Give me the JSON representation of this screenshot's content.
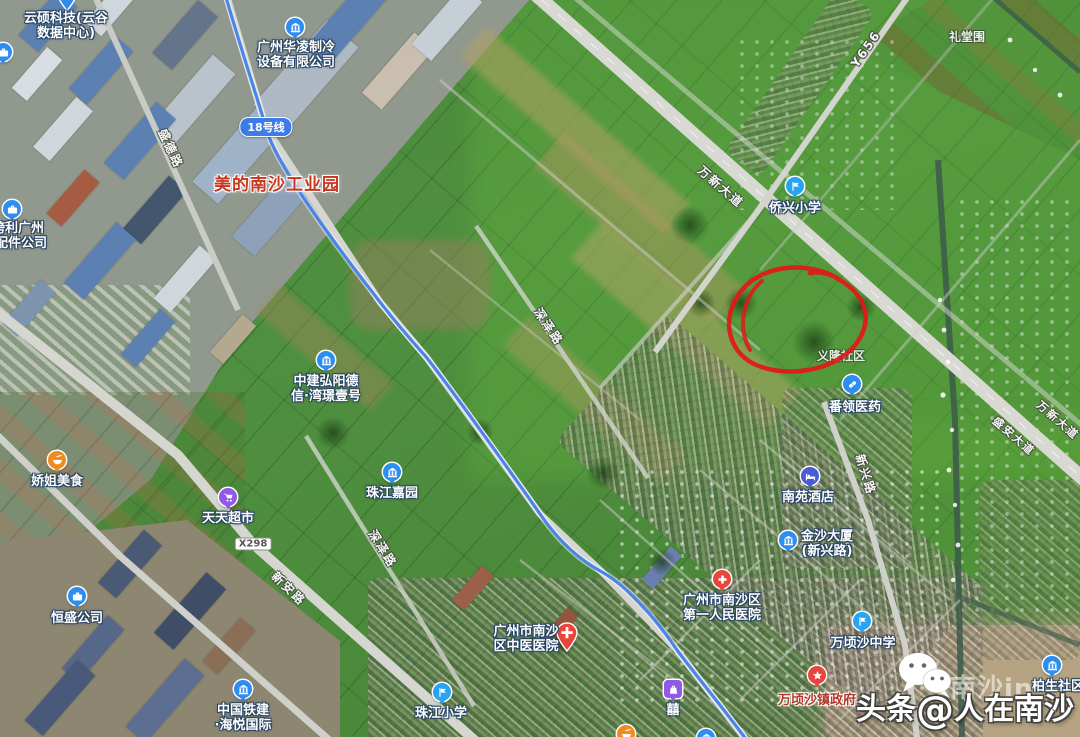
{
  "map_kind": "satellite",
  "badges": {
    "metro": "18号线",
    "road": "X298"
  },
  "area_labels": [
    {
      "text": "美的南沙工业园"
    },
    {
      "text": "礼堂围"
    },
    {
      "text": "义隆社区"
    }
  ],
  "road_labels": [
    {
      "text": "盛德路"
    },
    {
      "text": "万新大道"
    },
    {
      "text": "Y656"
    },
    {
      "text": "新兴路"
    },
    {
      "text": "深泽路"
    },
    {
      "text": "深泽路"
    },
    {
      "text": "新安路"
    },
    {
      "text": "盛安大道"
    },
    {
      "text": "万新大道"
    }
  ],
  "pois": [
    {
      "line1": "云硕科技(云谷",
      "line2": "数据中心)",
      "icon": "pin-icon",
      "color": "#2E8DF0"
    },
    {
      "line1": "广州华凌制冷",
      "line2": "设备有限公司",
      "icon": "factory-icon",
      "color": "#2E8DF0"
    },
    {
      "line1": "跨利广州",
      "line2": "配件公司",
      "icon": "briefcase-icon",
      "color": "#2E8DF0"
    },
    {
      "line1": "侨兴小学",
      "icon": "flag-icon",
      "color": "#29A4F2"
    },
    {
      "line1": "番领医药",
      "icon": "pill-icon",
      "color": "#2E8DF0"
    },
    {
      "line1": "南苑酒店",
      "icon": "bed-icon",
      "color": "#4A5BD8"
    },
    {
      "line1": "中建弘阳德",
      "line2": "信·湾璟壹号",
      "icon": "building-icon",
      "color": "#2E8DF0"
    },
    {
      "line1": "娇姐美食",
      "icon": "food-icon",
      "color": "#F08C1E"
    },
    {
      "line1": "天天超市",
      "icon": "cart-icon",
      "color": "#9059E8"
    },
    {
      "line1": "恒盛公司",
      "icon": "briefcase-icon",
      "color": "#2E8DF0"
    },
    {
      "line1": "珠江嘉园",
      "icon": "building-icon",
      "color": "#2E8DF0"
    },
    {
      "line1": "广州市南沙",
      "line2": "区中医医院",
      "icon": "cross-pin-icon",
      "color": "#E8463C"
    },
    {
      "line1": "广州市南沙区",
      "line2": "第一人民医院",
      "icon": "cross-icon",
      "color": "#E8463C"
    },
    {
      "line1": "金沙大厦",
      "line2": "(新兴路)",
      "icon": "building-icon",
      "color": "#2E8DF0"
    },
    {
      "line1": "万顷沙中学",
      "icon": "flag-icon",
      "color": "#29A4F2"
    },
    {
      "line1": "万顷沙镇政府",
      "icon": "star-icon",
      "color": "#E8463C"
    },
    {
      "line1": "囍",
      "icon": "bag-icon",
      "color": "#9059E8"
    },
    {
      "line1": "珠江小学",
      "icon": "flag-icon",
      "color": "#29A4F2"
    },
    {
      "line1": "中国铁建",
      "line2": "·海悦国际",
      "icon": "building-icon",
      "color": "#2E8DF0"
    },
    {
      "line1": "柏生社区",
      "icon": "building-icon",
      "color": "#2E8DF0"
    },
    {
      "line1": "",
      "icon": "building-icon",
      "color": "#2E8DF0"
    },
    {
      "line1": "",
      "icon": "food-icon",
      "color": "#F08C1E"
    },
    {
      "line1": "",
      "icon": "briefcase-icon",
      "color": "#2E8DF0"
    }
  ],
  "watermark": {
    "headline_left": "头条",
    "headline_at": "@",
    "headline_right": "人在南沙",
    "overlay": "南沙in"
  },
  "annotation": {
    "type": "hand-drawn-circle",
    "color": "#E21818"
  }
}
